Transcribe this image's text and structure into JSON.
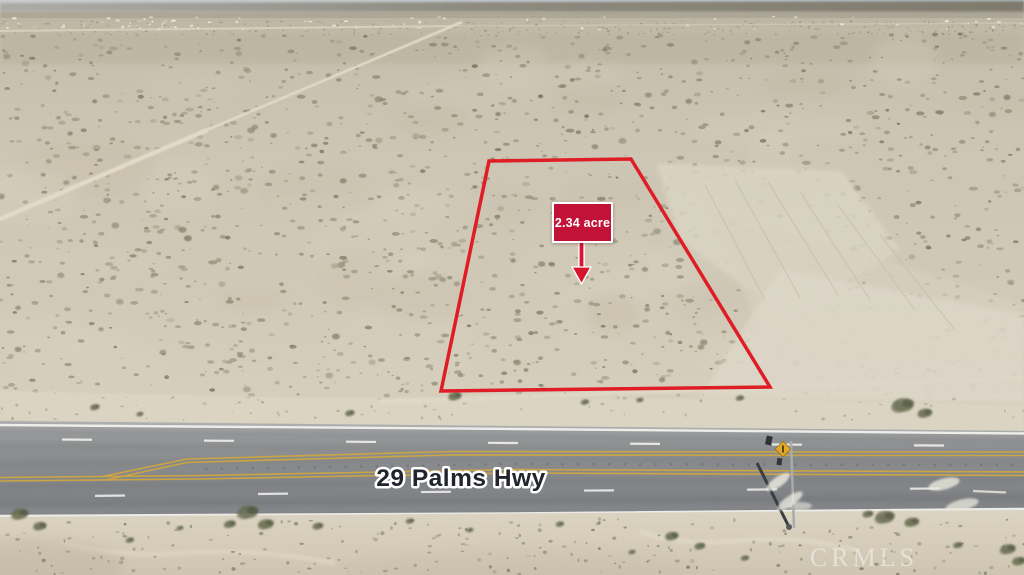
{
  "photo": {
    "type": "aerial-property-listing-photo",
    "labels": {
      "acreage": "2.34 acre",
      "highway_name": "29 Palms Hwy",
      "watermark": "CRMLS"
    },
    "overlay": {
      "boundary_points": "489,161 631,159 770,387 441,391",
      "boundary_color": "#df1d27",
      "boundary_stroke_width": 3.5,
      "acre_box": {
        "x": 552,
        "y": 202,
        "width": 61,
        "height": 41,
        "bg": "#c31237",
        "border_color": "#ffffff",
        "text_color": "#ffffff"
      },
      "arrow": {
        "x": 581.5,
        "top": 243,
        "stem_bottom": 268,
        "tip": 284,
        "half_width": 9.5,
        "color": "#d6152f",
        "outline": "#ffffff"
      },
      "highway_label": {
        "x": 461,
        "y": 486,
        "fill": "#22252d",
        "outline": "#ffffff"
      },
      "watermark": {
        "x": 864,
        "y": 558,
        "color": "rgba(255,255,255,0.45)"
      },
      "road_sign": {
        "warning_diamond_color": "#dfa826"
      }
    }
  }
}
